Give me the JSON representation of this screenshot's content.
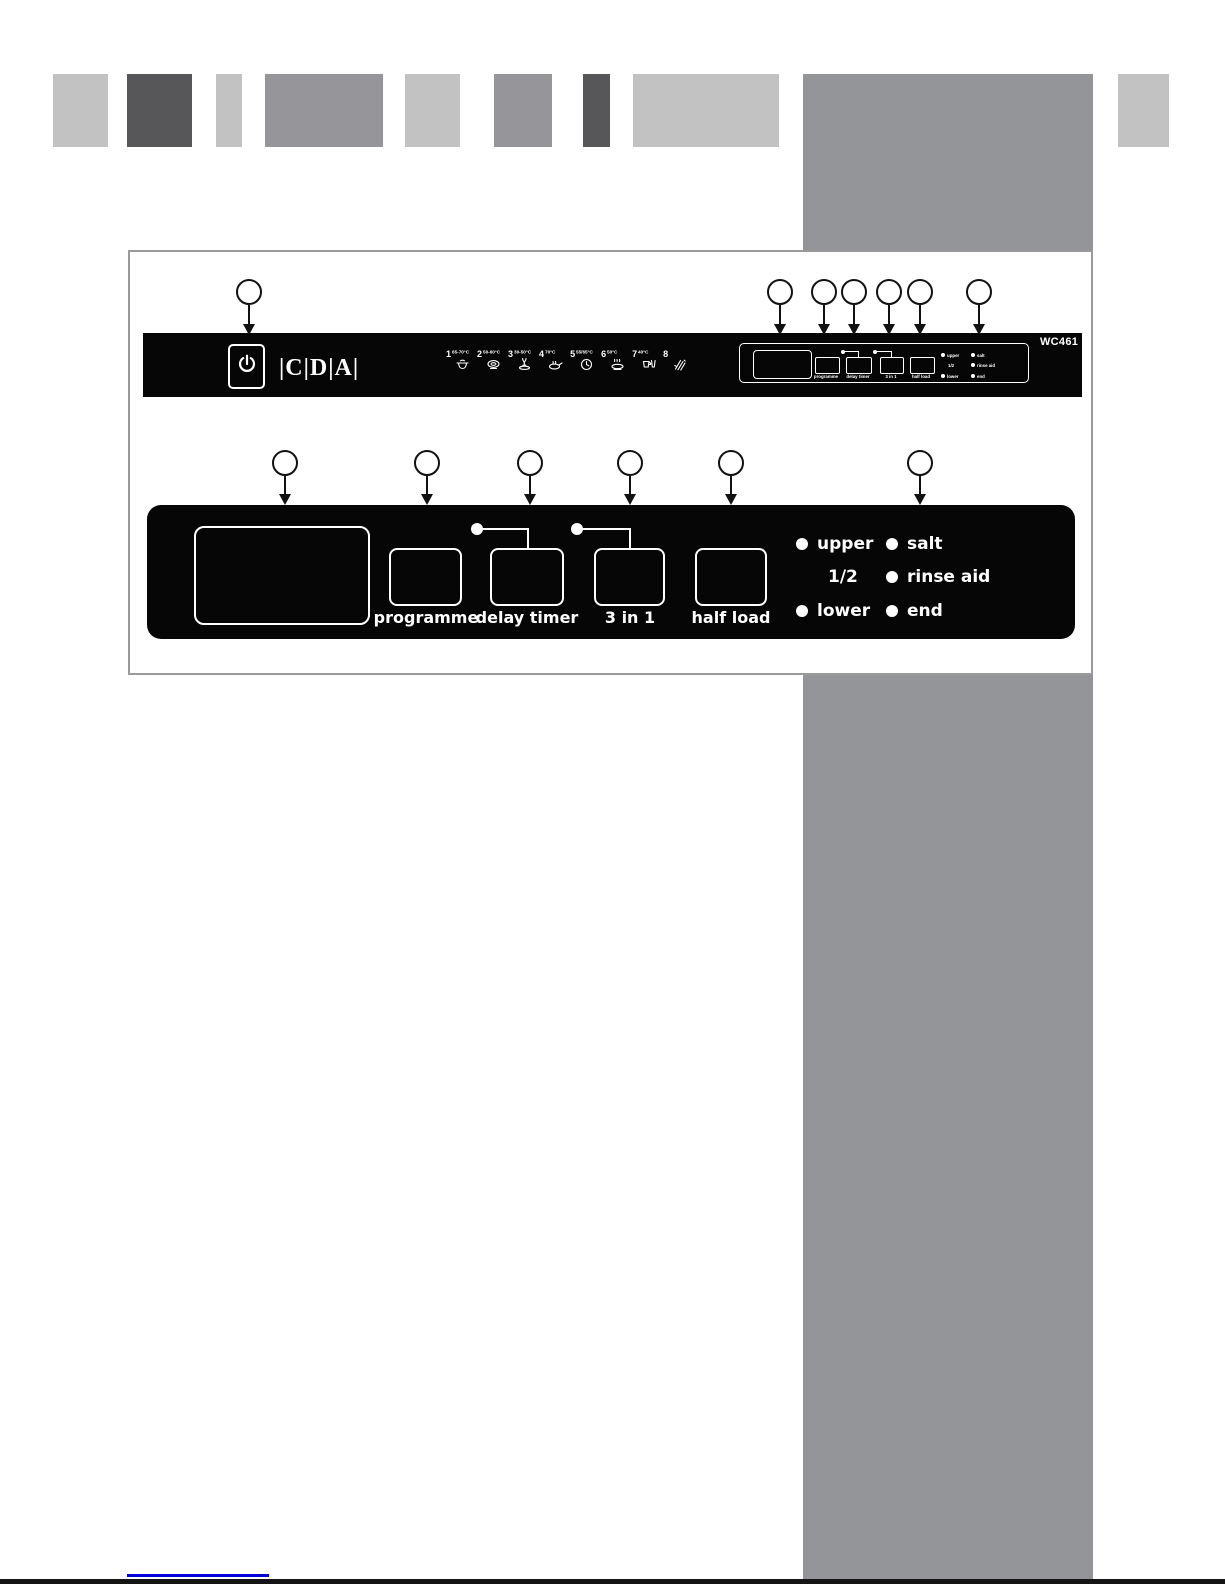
{
  "figure": {
    "brand": "CDA",
    "model": "WC461"
  },
  "top_panel": {
    "brand_logo": "|C|D|A|",
    "model_label": "WC461",
    "programmes": [
      {
        "number": "1",
        "temp": "65-70°C",
        "icon": "pot-icon"
      },
      {
        "number": "2",
        "temp": "50-60°C",
        "icon": "plate-icon"
      },
      {
        "number": "3",
        "temp": "30-50°C",
        "icon": "glass-plate-icon"
      },
      {
        "number": "4",
        "temp": "70°C",
        "icon": "pan-icon"
      },
      {
        "number": "5",
        "temp": "55/65°C",
        "icon": "clock-icon"
      },
      {
        "number": "6",
        "temp": "50°C",
        "icon": "eco-plate-icon"
      },
      {
        "number": "7",
        "temp": "40°C",
        "icon": "cup-glass-icon"
      },
      {
        "number": "8",
        "temp": "",
        "icon": "rinse-hand-icon"
      }
    ],
    "cluster": {
      "button_labels": [
        "programme",
        "delay timer",
        "3 in 1",
        "half load"
      ],
      "indicators_left": [
        "upper",
        "1/2",
        "lower"
      ],
      "indicators_right": [
        "salt",
        "rinse aid",
        "end"
      ]
    }
  },
  "main_panel": {
    "buttons": [
      {
        "label": "programme"
      },
      {
        "label": "delay timer"
      },
      {
        "label": "3 in 1"
      },
      {
        "label": "half load"
      }
    ],
    "indicators_left": [
      {
        "label": "upper",
        "has_led": true
      },
      {
        "label": "1/2",
        "has_led": false
      },
      {
        "label": "lower",
        "has_led": true
      }
    ],
    "indicators_right": [
      {
        "label": "salt",
        "has_led": true
      },
      {
        "label": "rinse aid",
        "has_led": true
      },
      {
        "label": "end",
        "has_led": true
      }
    ]
  },
  "colors": {
    "panel_black": "#060606",
    "deco_light": "#c2c2c3",
    "deco_medium": "#95959a",
    "deco_dark": "#57575a",
    "band_grey": "#949599",
    "link_blue": "#0000d8"
  }
}
